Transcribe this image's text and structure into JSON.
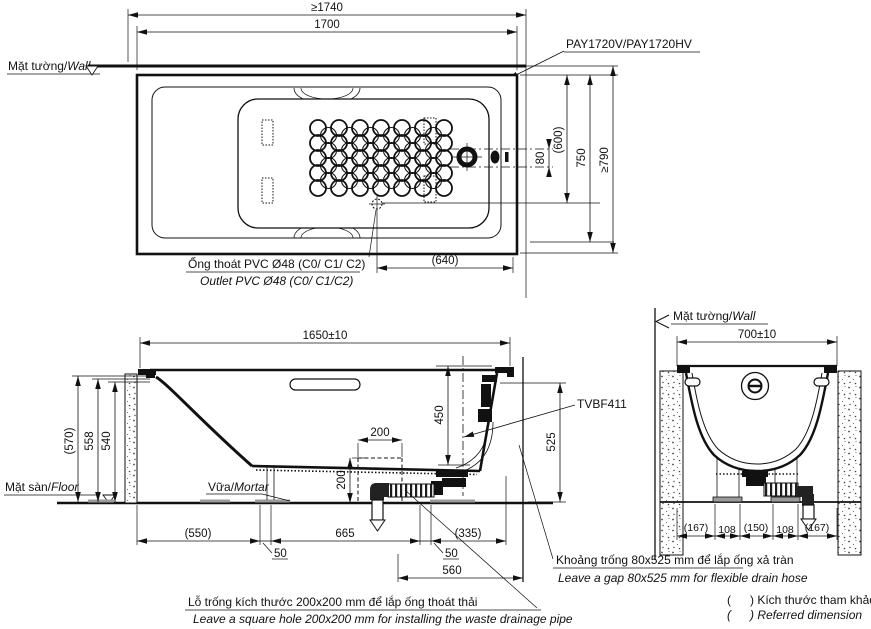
{
  "top_view": {
    "wall_label_vi": "Mặt tường/",
    "wall_label_en": "Wall",
    "dim_total_width": "≥1740",
    "dim_tub_width": "1700",
    "product_label": "PAY1720V/PAY1720HV",
    "dim_overflow_offset": "80",
    "dim_600": "(600)",
    "dim_750": "750",
    "dim_total_depth": "≥790",
    "outlet_vi": "Ống thoát PVC Ø48 (C0/ C1/ C2)",
    "outlet_en": "Outlet PVC Ø48 (C0/ C1/C2)",
    "dim_640": "(640)"
  },
  "side_view": {
    "dim_length": "1650±10",
    "dim_570": "(570)",
    "dim_558": "558",
    "dim_540": "540",
    "dim_450": "450",
    "dim_525": "525",
    "dim_hole_width": "200",
    "dim_hole_height": "200",
    "valve_label": "TVBF411",
    "floor_label_vi": "Mặt sàn/",
    "floor_label_en": "Floor",
    "mortar_label_vi": "Vữa/",
    "mortar_label_en": "Mortar",
    "dim_550": "(550)",
    "dim_50_left": "50",
    "dim_665": "665",
    "dim_50_right": "50",
    "dim_335": "(335)",
    "dim_560": "560"
  },
  "end_view": {
    "wall_label_vi": "Mặt tường/",
    "wall_label_en": "Wall",
    "dim_width": "700±10",
    "dim_167_left": "(167)",
    "dim_108_left": "108",
    "dim_150": "(150)",
    "dim_108_right": "108",
    "dim_167_right": "(167)"
  },
  "notes": {
    "gap_vi": "Khoảng trống 80x525 mm để lắp ống xả tràn",
    "gap_en": "Leave a gap 80x525 mm for flexible drain hose",
    "hole_vi": "Lỗ trống kích thước 200x200 mm để lắp ống thoát thải",
    "hole_en": "Leave a square hole 200x200 mm for installing the waste drainage pipe",
    "legend_paren_1": "(",
    "legend_paren_2": "(",
    "legend_vi": ") Kích thước tham khảo",
    "legend_en": ") Referred dimension"
  }
}
